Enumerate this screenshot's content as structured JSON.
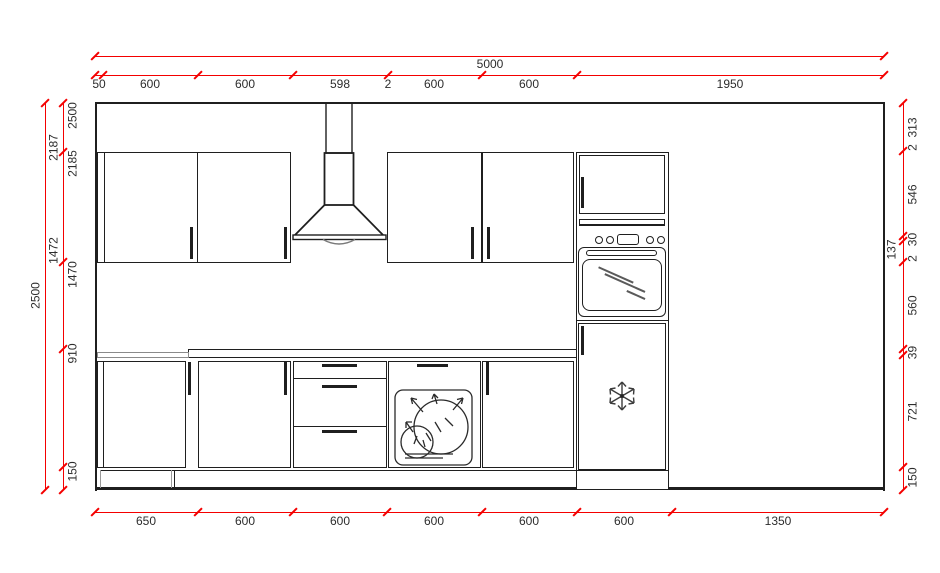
{
  "drawing_type": "kitchen-elevation-cad-drawing",
  "colors": {
    "dimension_red": "#f40000",
    "line_black": "#1f1f1f"
  },
  "icons": {
    "hood": "chimney-cooker-hood-icon",
    "oven": "built-in-oven-icon",
    "dishwasher": "dishwasher-plates-icon",
    "freezer": "snowflake-icon"
  },
  "dimensions": {
    "top": {
      "overall": "5000",
      "segments": [
        "50",
        "600",
        "600",
        "598",
        "2",
        "600",
        "600",
        "1950"
      ]
    },
    "bottom": {
      "segments": [
        "650",
        "600",
        "600",
        "600",
        "600",
        "600",
        "1350"
      ]
    },
    "left": {
      "overall": "2500",
      "ordinates": [
        "2500",
        "2187",
        "2185",
        "1472",
        "1470",
        "910",
        "150"
      ]
    },
    "right": {
      "segments": [
        "313",
        "2",
        "546",
        "30",
        "137",
        "2",
        "560",
        "39",
        "721",
        "150"
      ]
    }
  }
}
